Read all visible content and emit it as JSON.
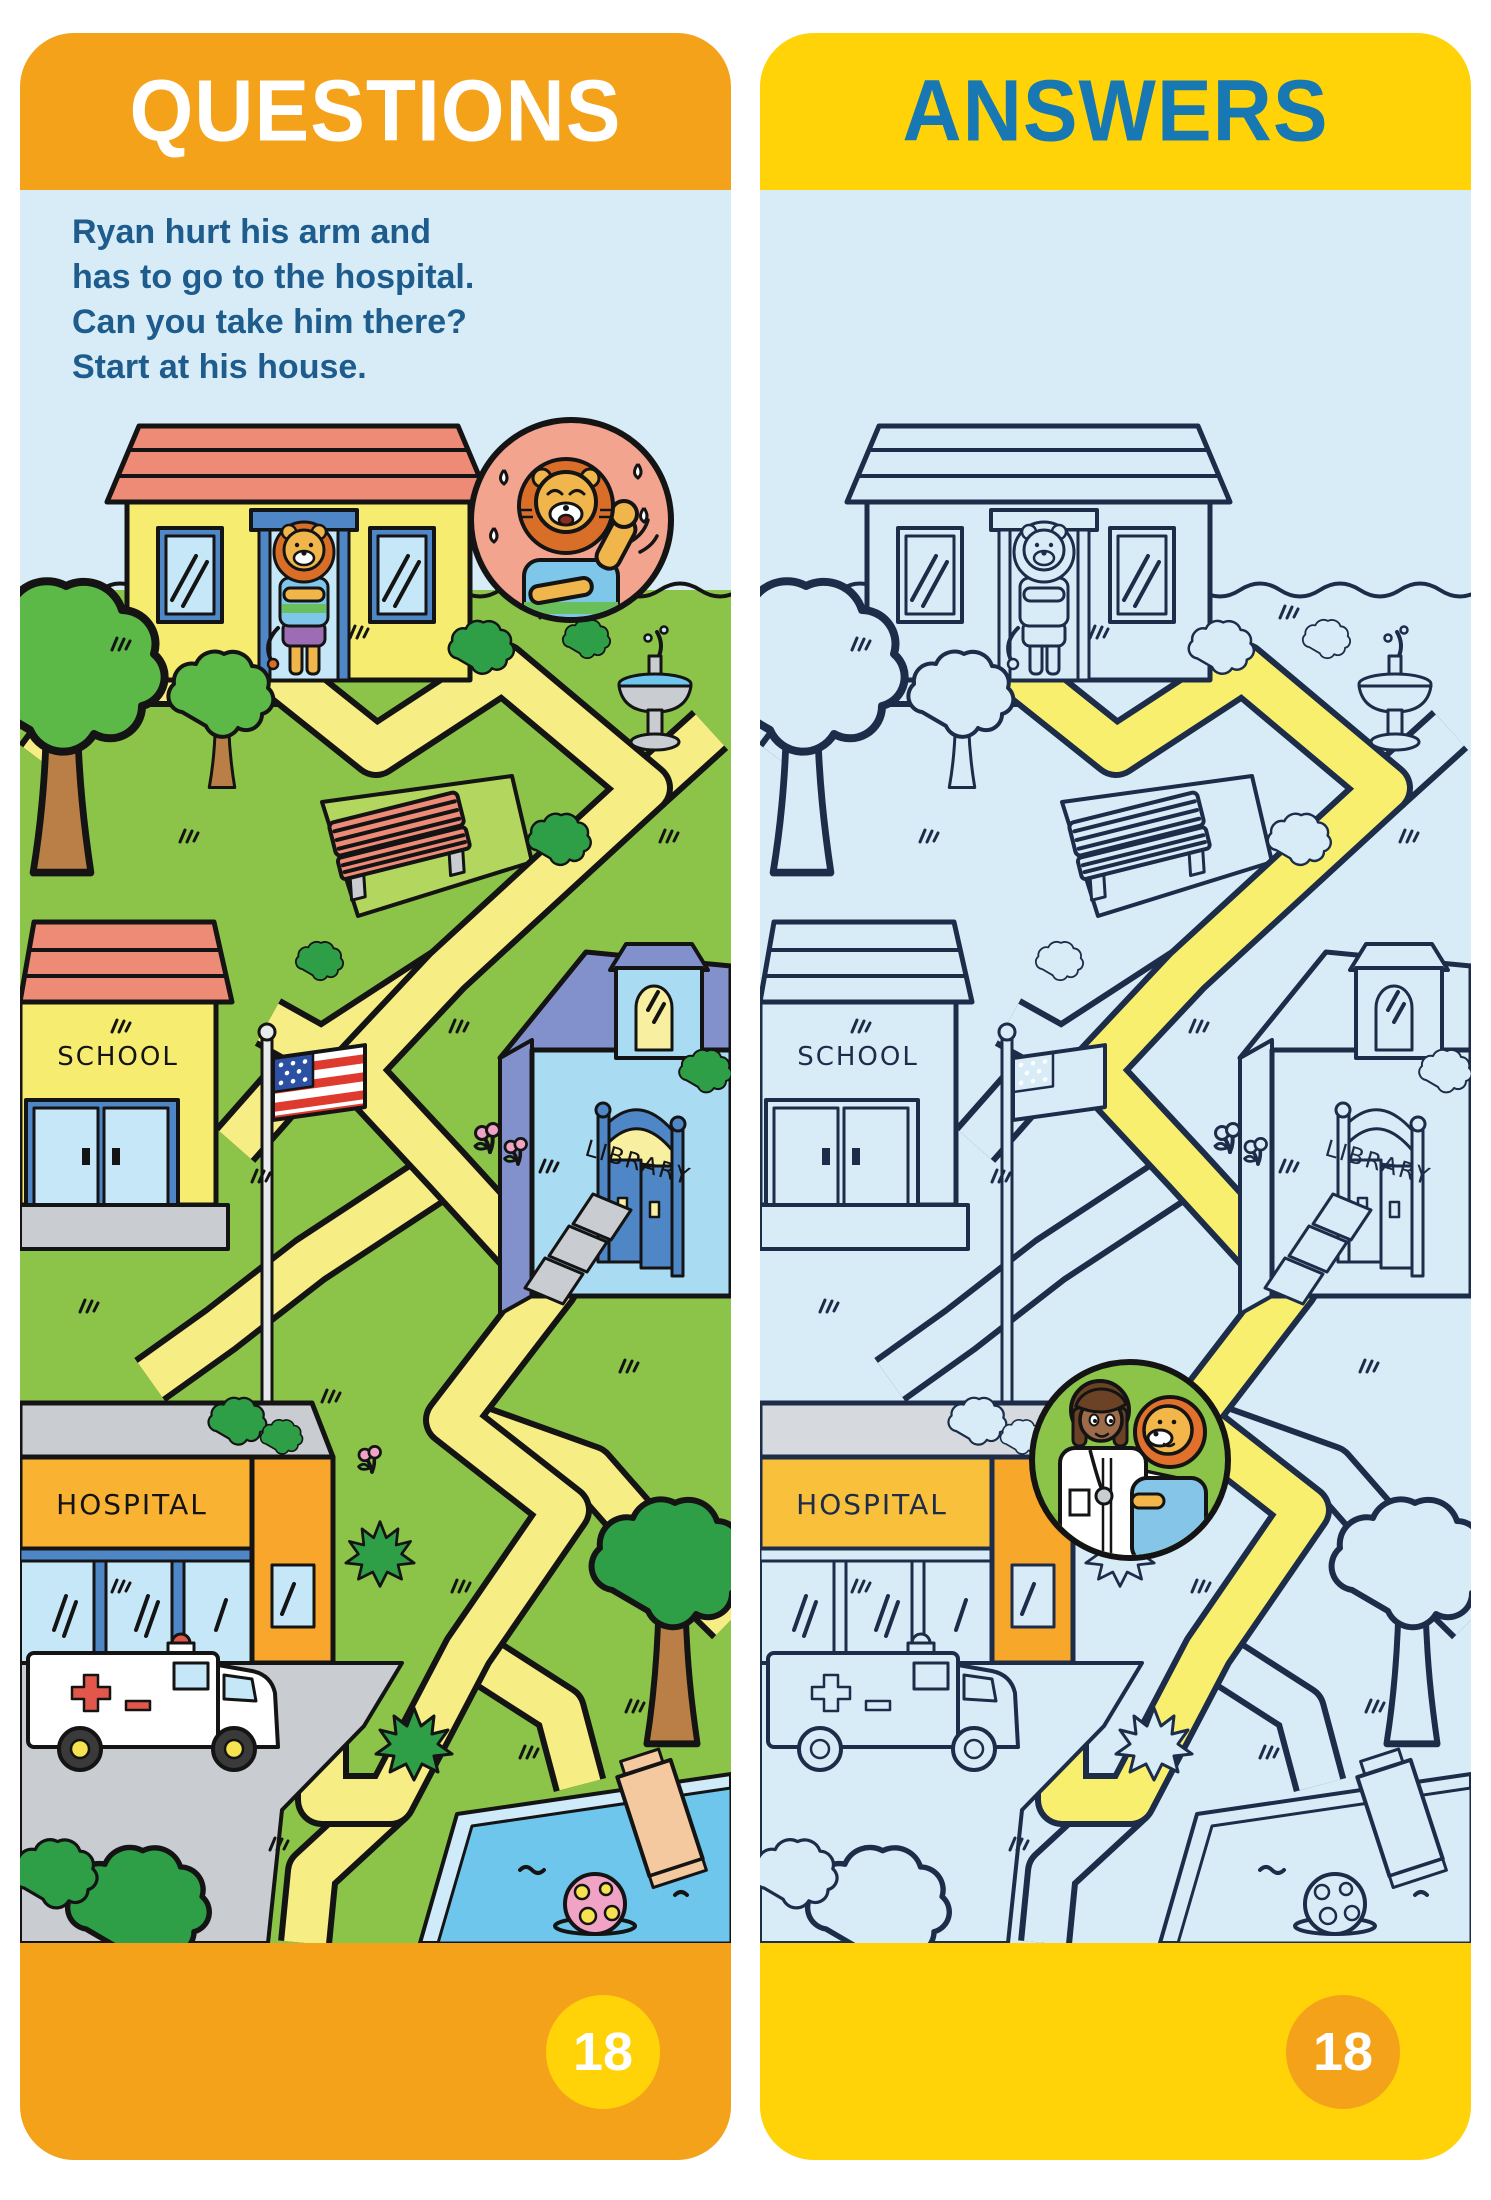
{
  "page": {
    "background": "#FFFFFF"
  },
  "colors": {
    "orange": "#F5A21B",
    "yellow": "#FFD307",
    "answers_blue": "#1878B4",
    "instruction_blue": "#1D5C8C",
    "panel_background": "#D8ECF7",
    "solution_path_yellow": "#F8EF6E",
    "page_number_text": "#FFFFFF"
  },
  "questions_panel": {
    "header": "QUESTIONS",
    "instructions": [
      "Ryan hurt his arm and",
      "has to go to the hospital.",
      "Can you take him there?",
      "Start at his house."
    ],
    "labels": {
      "school": "SCHOOL",
      "library": "LIBRARY",
      "hospital": "HOSPITAL"
    },
    "page_number": "18"
  },
  "answers_panel": {
    "header": "ANSWERS",
    "labels": {
      "school": "SCHOOL",
      "library": "LIBRARY",
      "hospital": "HOSPITAL"
    },
    "page_number": "18"
  }
}
